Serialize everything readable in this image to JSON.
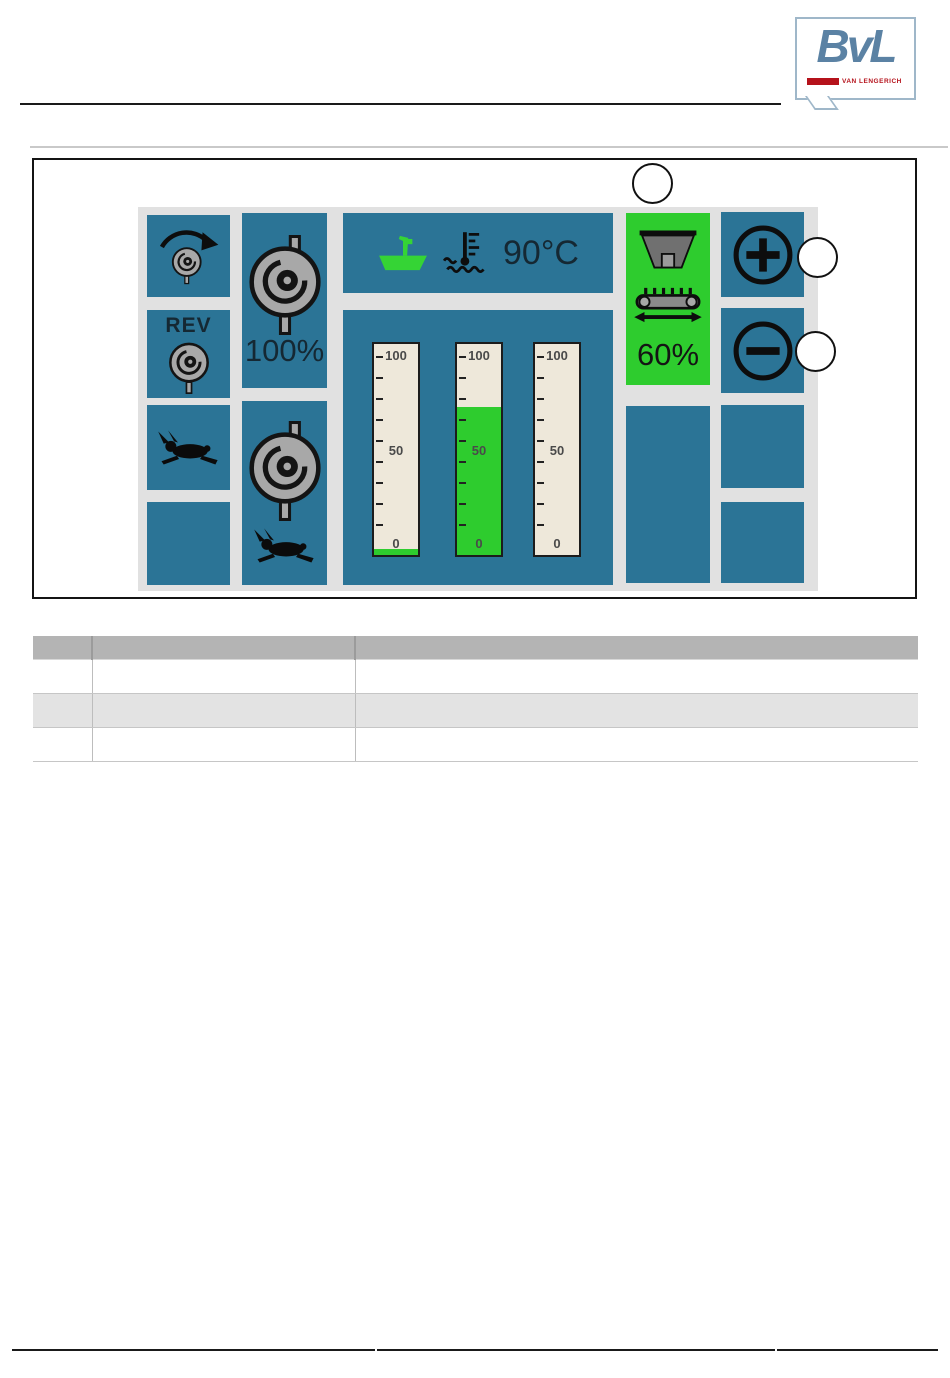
{
  "brand": {
    "logo_text": "BvL",
    "logo_subtext": "VAN LENGERICH"
  },
  "hmi": {
    "reverse_label": "REV",
    "mixer_auger_speed": "100%",
    "water_temperature": "90°C",
    "cross_conveyor_speed": "60%",
    "gauges": [
      {
        "top_label": "100",
        "mid_label": "50",
        "bottom_label": "0",
        "fill_percent": 3
      },
      {
        "top_label": "100",
        "mid_label": "50",
        "bottom_label": "0",
        "fill_percent": 70
      },
      {
        "top_label": "100",
        "mid_label": "50",
        "bottom_label": "0",
        "fill_percent": 0
      }
    ],
    "callouts": [
      "",
      "",
      ""
    ],
    "colors": {
      "tile_blue": "#2b7496",
      "active_green": "#2ecc2e",
      "panel_background": "#e1e1e1",
      "gauge_background": "#eee8da"
    }
  },
  "table": {
    "headers": [
      "",
      "",
      ""
    ],
    "rows": [
      [
        "",
        "",
        ""
      ],
      [
        "",
        "",
        ""
      ],
      [
        "",
        "",
        ""
      ]
    ]
  }
}
